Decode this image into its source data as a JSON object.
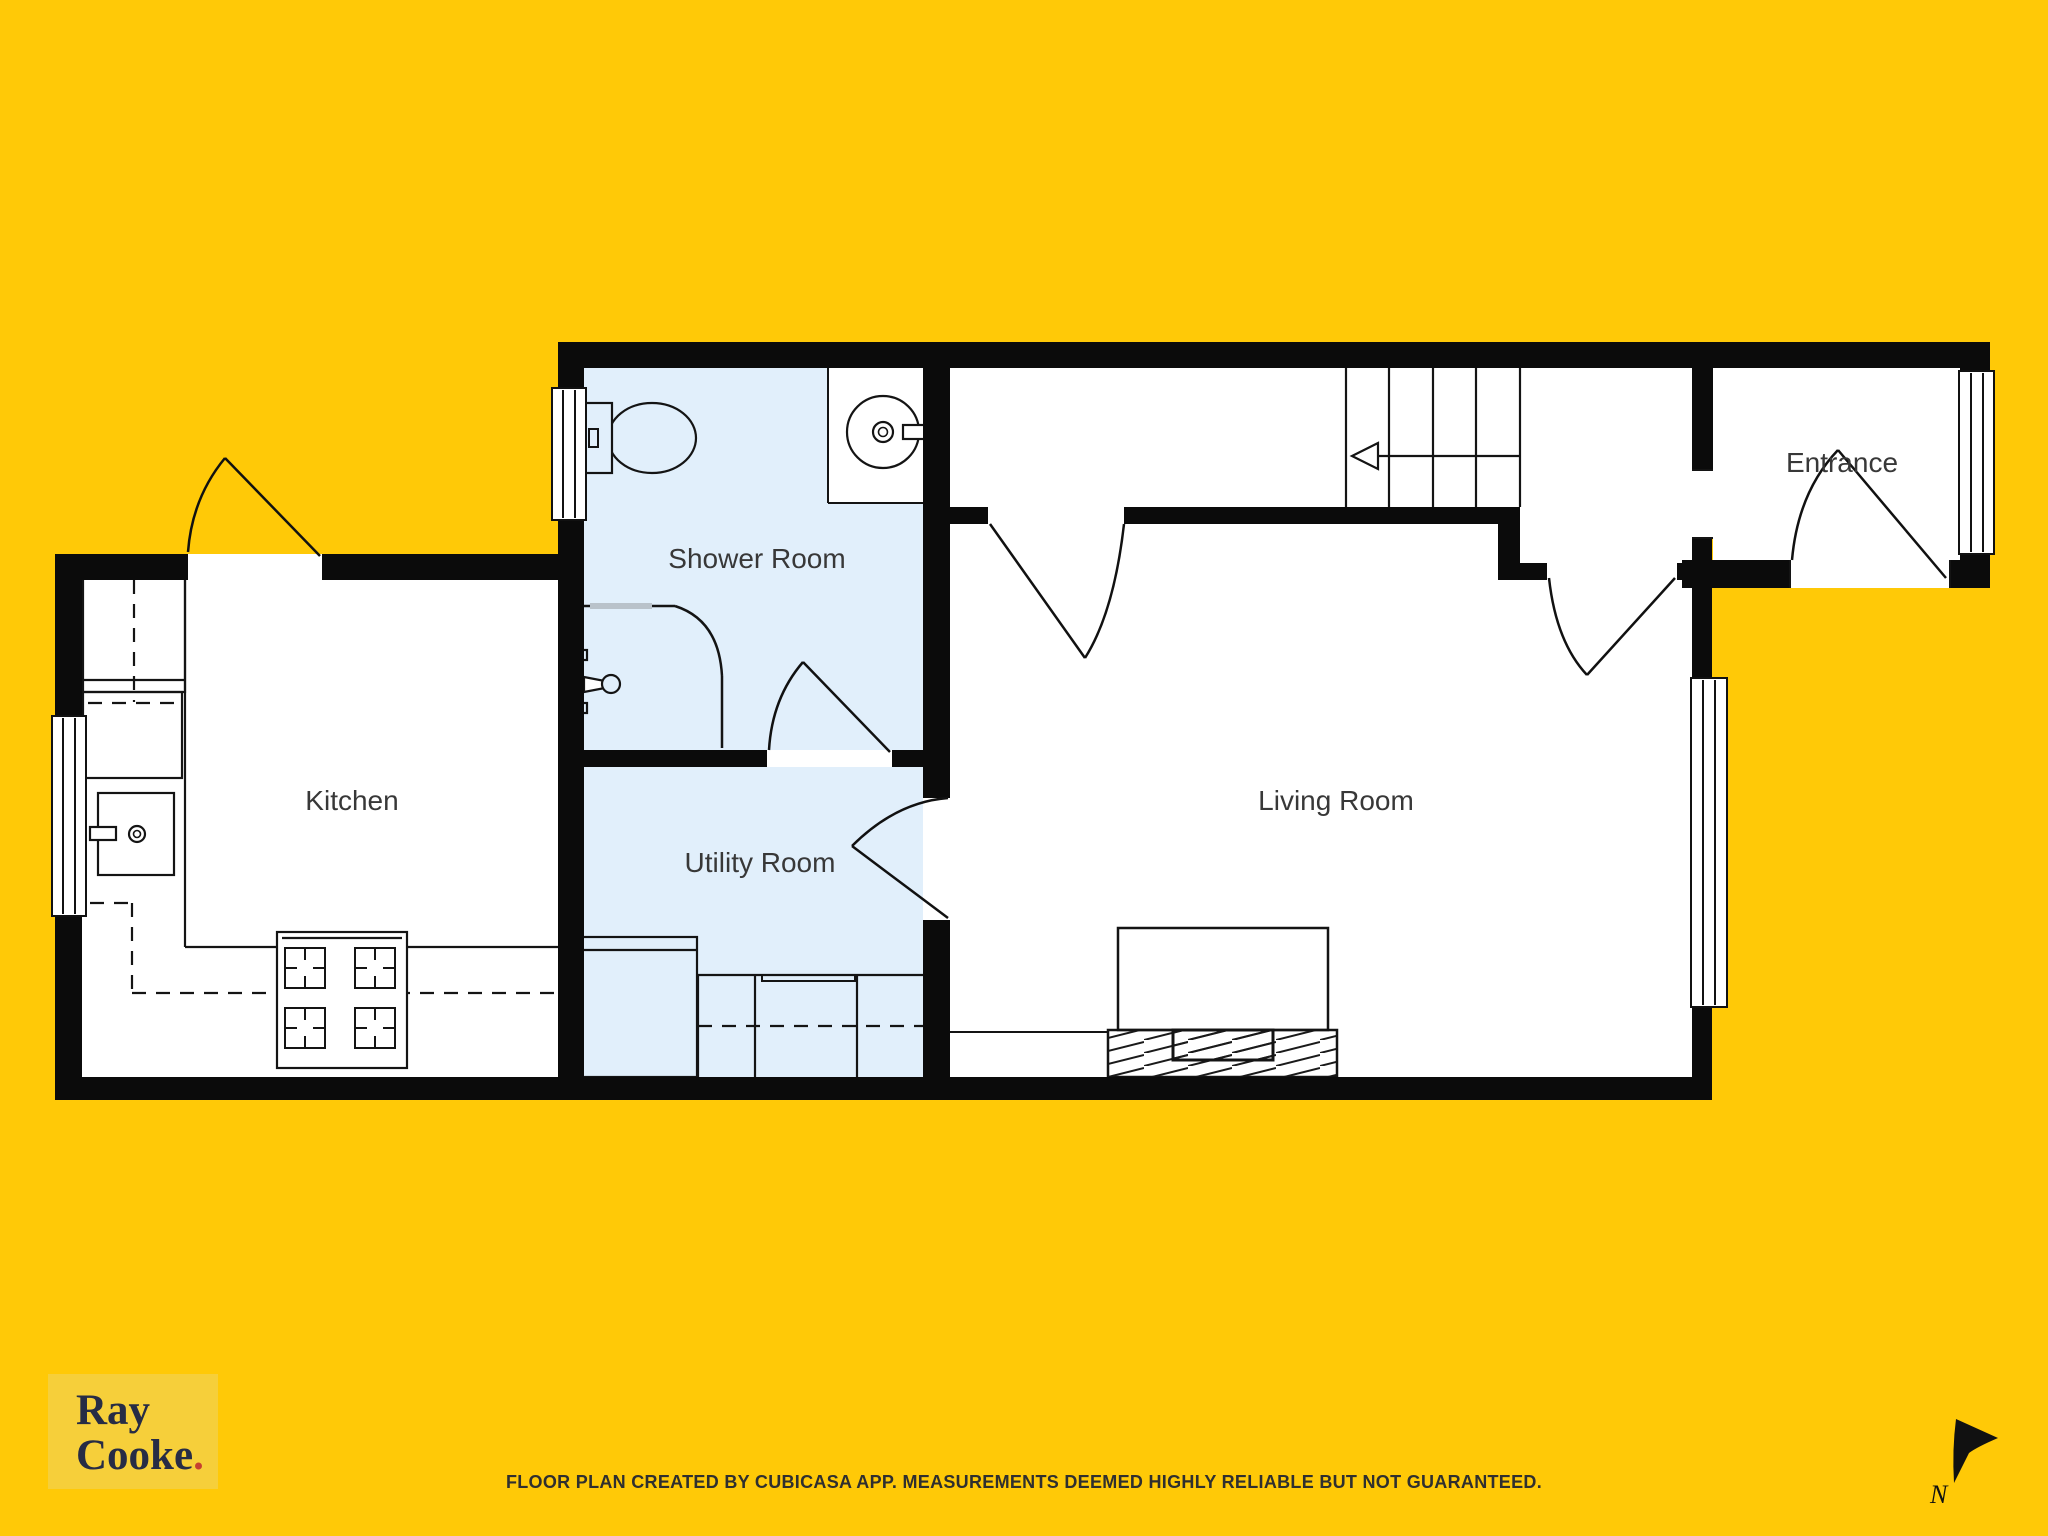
{
  "rooms": {
    "shower": "Shower Room",
    "kitchen": "Kitchen",
    "utility": "Utility Room",
    "living": "Living Room",
    "entrance": "Entrance"
  },
  "branding": {
    "line1": "Ray",
    "line2": "Cooke",
    "dot": ".",
    "panel_color": "#f6cf3a",
    "text_color": "#272c45",
    "dot_color": "#c63f30"
  },
  "footer": {
    "disclaimer": "FLOOR PLAN CREATED BY CUBICASA APP. MEASUREMENTS DEEMED HIGHLY RELIABLE BUT NOT GUARANTEED."
  },
  "compass": {
    "label": "N"
  },
  "colors": {
    "background": "#ffc907",
    "wall": "#0b0b0b",
    "wet_floor": "#e1effb",
    "dry_floor": "#ffffff",
    "line": "#141414"
  }
}
